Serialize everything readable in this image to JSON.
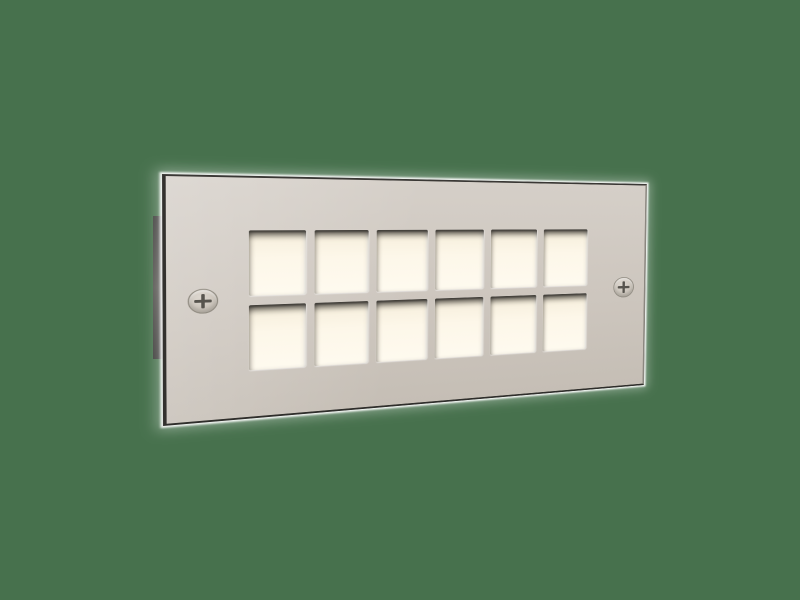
{
  "scene": {
    "subject": "recessed brick step light faceplate, perspective product render",
    "background_color": "#47714D",
    "plate": {
      "face_color_top": "#d5cfc8",
      "face_color_bottom": "#c5beb5",
      "edge_dark_color": "#33312e",
      "edge_right_color": "#8b8780",
      "rim_glow_color": "#ffffff",
      "grid": {
        "rows": 2,
        "cols": 6,
        "window_count": 12
      },
      "window_glow_color": "#fdf7e9",
      "window_lip_shadow_color": "#403d38",
      "screws": {
        "count": 2,
        "positions": [
          "left",
          "right"
        ],
        "slot_color": "#57544e",
        "rim_color": "#8e897f"
      }
    },
    "housing_edge_color": "#55534f"
  }
}
